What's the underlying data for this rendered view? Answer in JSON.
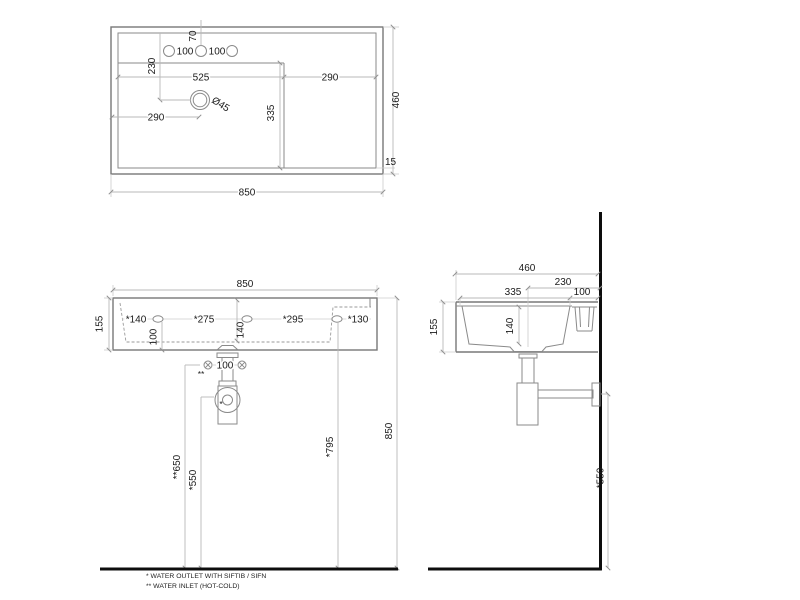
{
  "views": {
    "top": {
      "width_total": "850",
      "depth_total": "460",
      "basin_width": "525",
      "deck_width": "290",
      "drain_offset_x": "290",
      "drain_offset_y": "230",
      "hole_gap_left": "100",
      "hole_gap_right": "100",
      "hole_edge_offset": "70",
      "basin_depth": "335",
      "drain_diameter": "Ø45",
      "rim_lip": "15"
    },
    "front": {
      "width_total": "850",
      "height_body": "155",
      "outlet_1": "*140",
      "outlet_2": "*275",
      "outlet_3": "*295",
      "outlet_4": "*130",
      "overflow_height": "100",
      "inner_depth": "140",
      "inlet_gap": "100",
      "inlet_mark": "**",
      "outlet_mark": "*",
      "inlet_height": "**650",
      "trap_height": "*550",
      "outlet_height": "*795",
      "rim_height": "850"
    },
    "side": {
      "depth_total": "460",
      "drain_to_wall": "230",
      "inner_width": "335",
      "back_ledge": "100",
      "height_body": "155",
      "inner_depth": "140",
      "wall_outlet_height": "*550"
    },
    "footnotes": {
      "line1": "* WATER OUTLET WITH SIFTIB / SIFN",
      "line2": "** WATER INLET  (HOT-COLD)"
    }
  }
}
